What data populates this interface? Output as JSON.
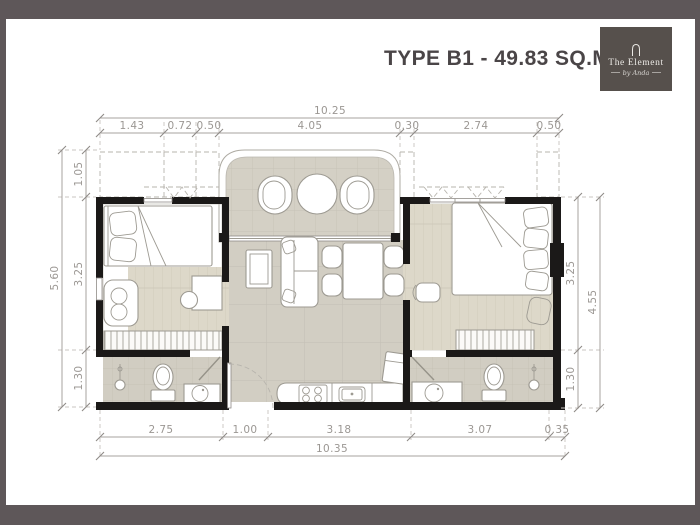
{
  "title": "TYPE B1 - 49.83 SQ.M.",
  "logo": {
    "brand": "The Element",
    "tagline": "by Anda"
  },
  "dimensions": {
    "top_total": "10.25",
    "top_segments": [
      "1.43",
      "0.72",
      "0.50",
      "4.05",
      "0.30",
      "2.74",
      "0.50"
    ],
    "left_outer": "5.60",
    "left_segments": [
      "1.05",
      "3.25",
      "1.30"
    ],
    "right_segments": [
      "3.25",
      "1.30"
    ],
    "right_outer": "4.55",
    "bottom_segments": [
      "2.75",
      "1.00",
      "3.18",
      "3.07",
      "0.35"
    ],
    "bottom_total": "10.35"
  },
  "colors": {
    "background": "#5e5759",
    "logo_background": "#56504c",
    "title_text": "#4a4547",
    "walls": "#1b1918",
    "tile_floor": "#d2cec3",
    "wood_floor": "#ddd8c9",
    "dimension_text": "#9b9793"
  }
}
